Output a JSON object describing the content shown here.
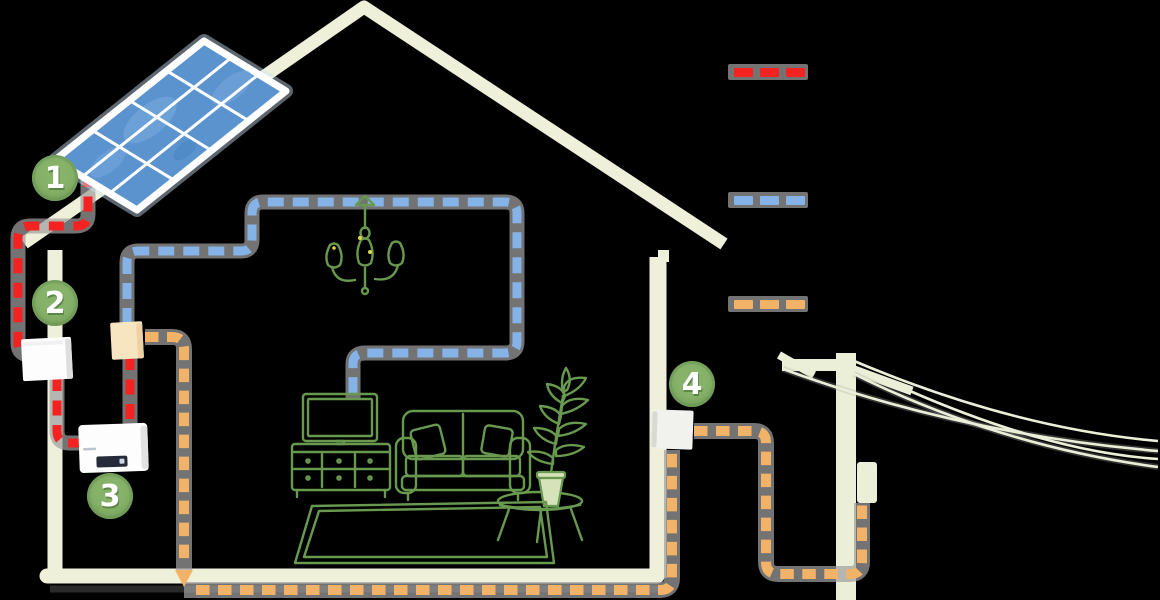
{
  "canvas": {
    "width": 1160,
    "height": 600,
    "background": "#000000"
  },
  "colors": {
    "dc-red": "#f42322",
    "ac-blue": "#85b3e8",
    "grid-orange": "#f2b369",
    "casing-gray": "rgba(160,160,160,0.72)",
    "house-beige": "#eef0da",
    "pole-beige": "#ecefd8",
    "furniture-green": "#68994f",
    "badge-green": "#86b269",
    "panel-blue": "#5b93cf",
    "panel-blue-light": "#74a9dc",
    "box-tan": "#f7e4c1",
    "box-white": "#fdfdfd",
    "meter-gray": "#f1f1ee",
    "display-navy": "#262b3a",
    "flame-yellow": "#e3d24b"
  },
  "badges": [
    {
      "number": "1"
    },
    {
      "number": "2"
    },
    {
      "number": "3"
    },
    {
      "number": "4"
    }
  ],
  "legend": {
    "items": [
      {
        "id": "dc-cable",
        "color": "#f42322"
      },
      {
        "id": "ac-cable",
        "color": "#85b3e8"
      },
      {
        "id": "grid-cable",
        "color": "#f2b369"
      }
    ]
  }
}
